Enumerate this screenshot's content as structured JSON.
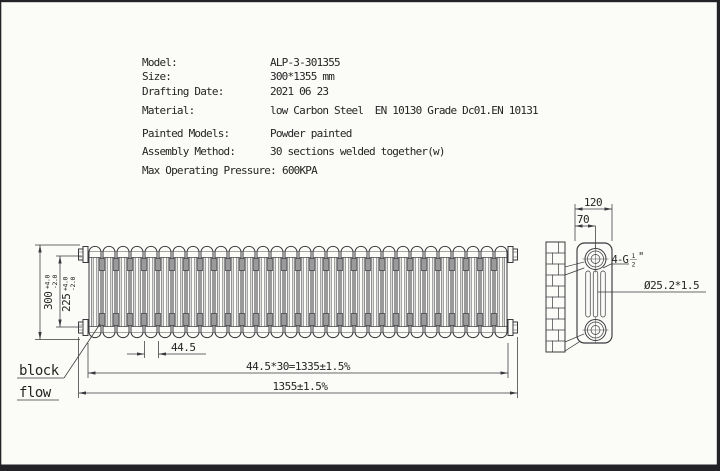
{
  "sheet": {
    "ink": "#3a3a3e",
    "text_ink": "#242424",
    "bg": "#fbfbf8",
    "frame": "#232327"
  },
  "spec_table": {
    "rows": [
      {
        "label": "Model:",
        "value": "ALP-3-301355"
      },
      {
        "label": "Size:",
        "value": "300*1355 mm"
      },
      {
        "label": "Drafting Date:",
        "value": "2021 06 23"
      },
      {
        "label": "Material:",
        "value": "low Carbon Steel  EN 10130 Grade Dc01.EN 10131"
      },
      {
        "label": "Painted Models:",
        "value": "Powder painted"
      },
      {
        "label": "Assembly Method:",
        "value": "30 sections welded together(w)"
      },
      {
        "label": "Max Operating Pressure:",
        "value": "600KPA"
      }
    ]
  },
  "front_view": {
    "section_count": 30,
    "dim_height": {
      "value": "300",
      "tol_plus": "+4.0",
      "tol_minus": "-2.0"
    },
    "dim_tapping": {
      "value": "225",
      "tol_plus": "+4.0",
      "tol_minus": "-2.0"
    },
    "dim_pitch": "44.5",
    "dim_sections_total": "44.5*30=1335±1.5%",
    "dim_overall": "1355±1.5%",
    "note_line1": "block",
    "note_line2": "flow"
  },
  "side_view": {
    "dim_depth": "120",
    "dim_wall_to_center": "70",
    "thread_callout": {
      "prefix": "4-G",
      "numerator": "1",
      "denominator": "2",
      "suffix": "\""
    },
    "tube_callout": "Ø25.2*1.5"
  }
}
